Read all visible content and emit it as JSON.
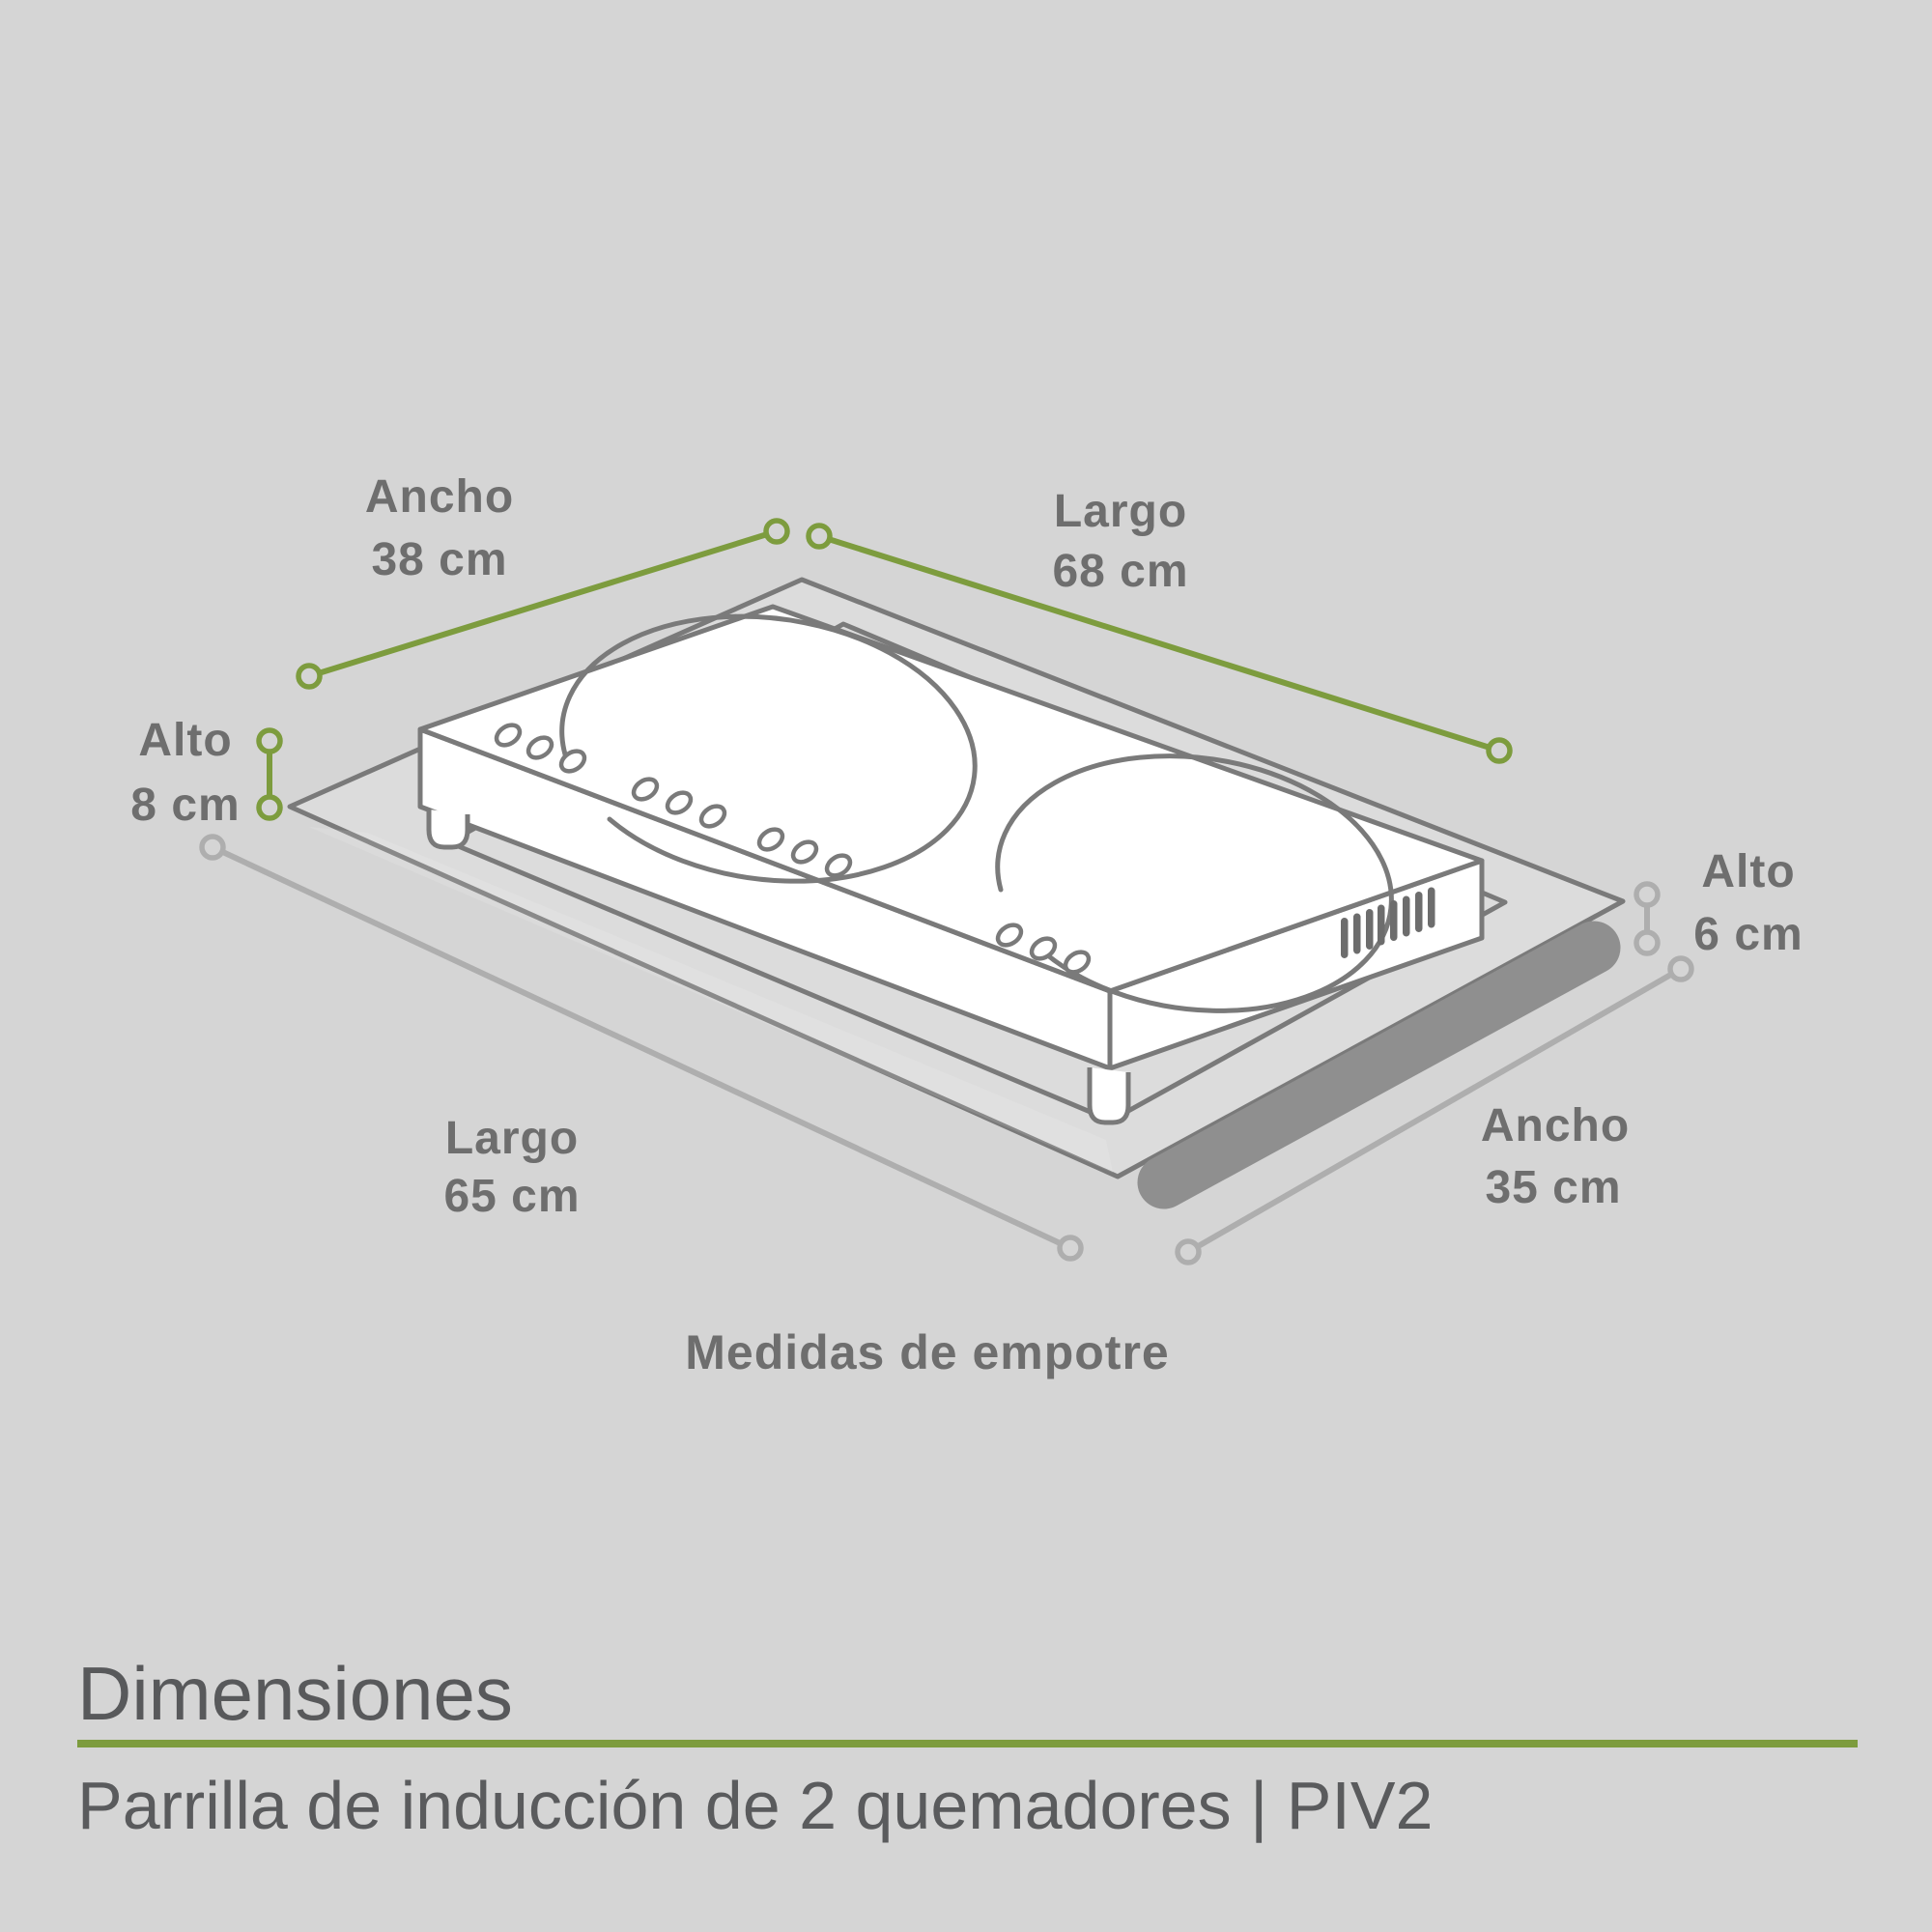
{
  "colors": {
    "background": "#d5d5d5",
    "accent_green": "#7d9c3e",
    "dim_gray": "#aeaeae",
    "drawing_gray": "#7a7a7a",
    "shadow_gray": "#8f8f8f",
    "label_gray": "#6e6e6e",
    "footer_text": "#58595b"
  },
  "dimensions": {
    "ancho_top": {
      "label": "Ancho",
      "value": "38 cm"
    },
    "largo_top": {
      "label": "Largo",
      "value": "68 cm"
    },
    "alto_left": {
      "label": "Alto",
      "value": "8 cm"
    },
    "alto_right": {
      "label": "Alto",
      "value": "6 cm"
    },
    "largo_bottom": {
      "label": "Largo",
      "value": "65 cm"
    },
    "ancho_bottom": {
      "label": "Ancho",
      "value": "35 cm"
    }
  },
  "caption": "Medidas de empotre",
  "footer": {
    "title": "Dimensiones",
    "subtitle": "Parrilla de inducción de 2 quemadores | PIV2"
  }
}
